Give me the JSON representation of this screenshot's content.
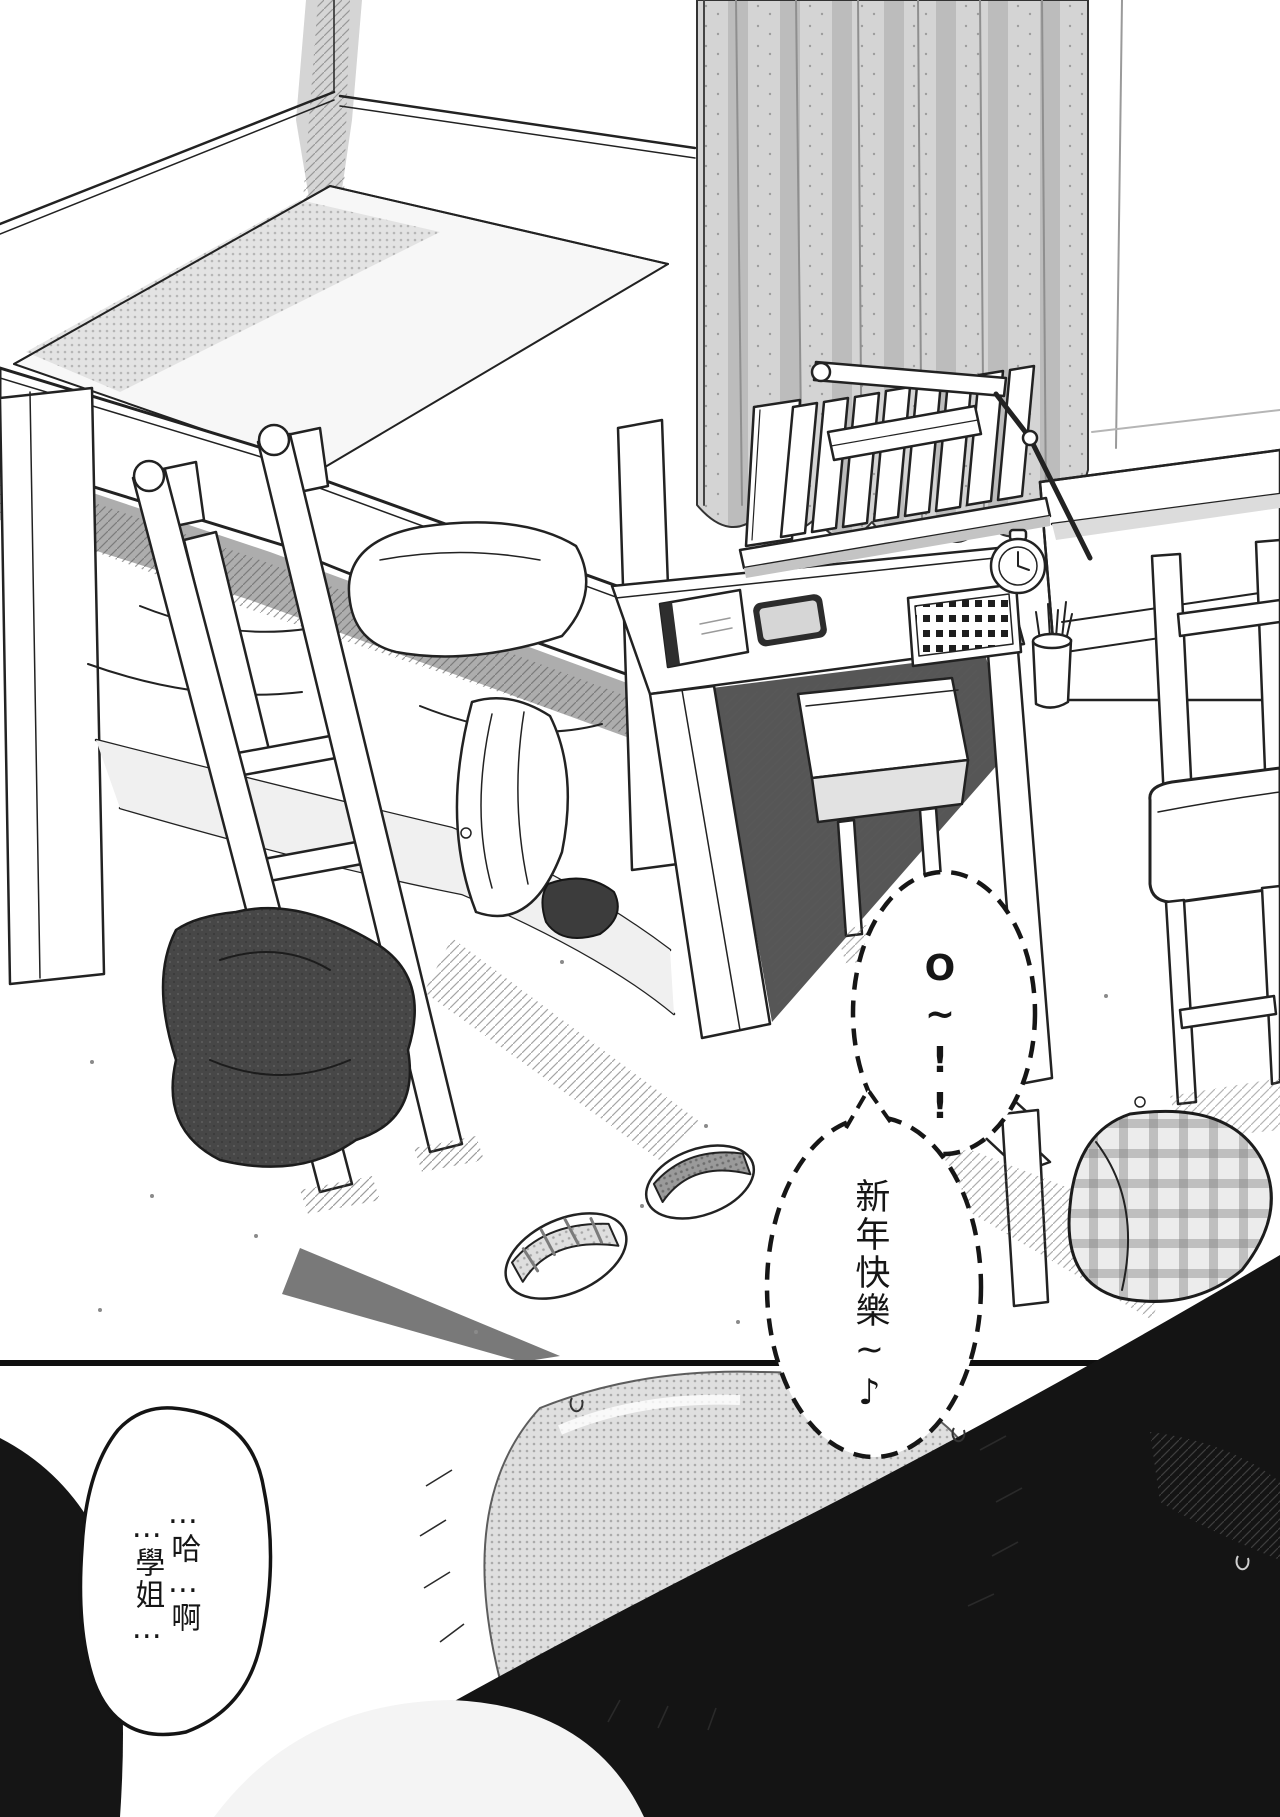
{
  "page": {
    "kind": "black-and-white manga page",
    "panel_count": 2,
    "reading_order": "right-to-left"
  },
  "colors": {
    "ink": "#1a1a1a",
    "paper": "#ffffff",
    "halftone_light": "#d9d9d9",
    "halftone_mid": "#a8a8a8",
    "shadow_dark": "#141414"
  },
  "panels": {
    "top": {
      "name": "bedroom-scene",
      "objects": [
        "bunk-bed",
        "ladder",
        "bedding",
        "pillow",
        "desk",
        "desk-hutch-books",
        "flat-book",
        "speaker-grille",
        "alarm-clock",
        "pencil-cup",
        "phone",
        "notebook",
        "desk-lamp",
        "curtain",
        "nightstand",
        "stool",
        "chair",
        "fallen-stool",
        "plaid-cushion",
        "slippers",
        "clothes-pile",
        "hair-tie"
      ]
    },
    "bottom": {
      "name": "closeup-scene-abstracted",
      "objects": [
        "abstract-shading",
        "sweat-drops"
      ]
    }
  },
  "speech_bubbles": [
    {
      "id": "bubble-exclaim",
      "style": "dashed-ellipse",
      "orientation": "vertical",
      "text": "O~!!"
    },
    {
      "id": "bubble-greeting",
      "style": "dashed-ellipse",
      "orientation": "vertical",
      "text": "新年快樂~♪"
    },
    {
      "id": "bubble-moan",
      "style": "solid-blob",
      "orientation": "vertical",
      "columns": [
        "…哈…啊",
        "…學姐…"
      ]
    }
  ]
}
